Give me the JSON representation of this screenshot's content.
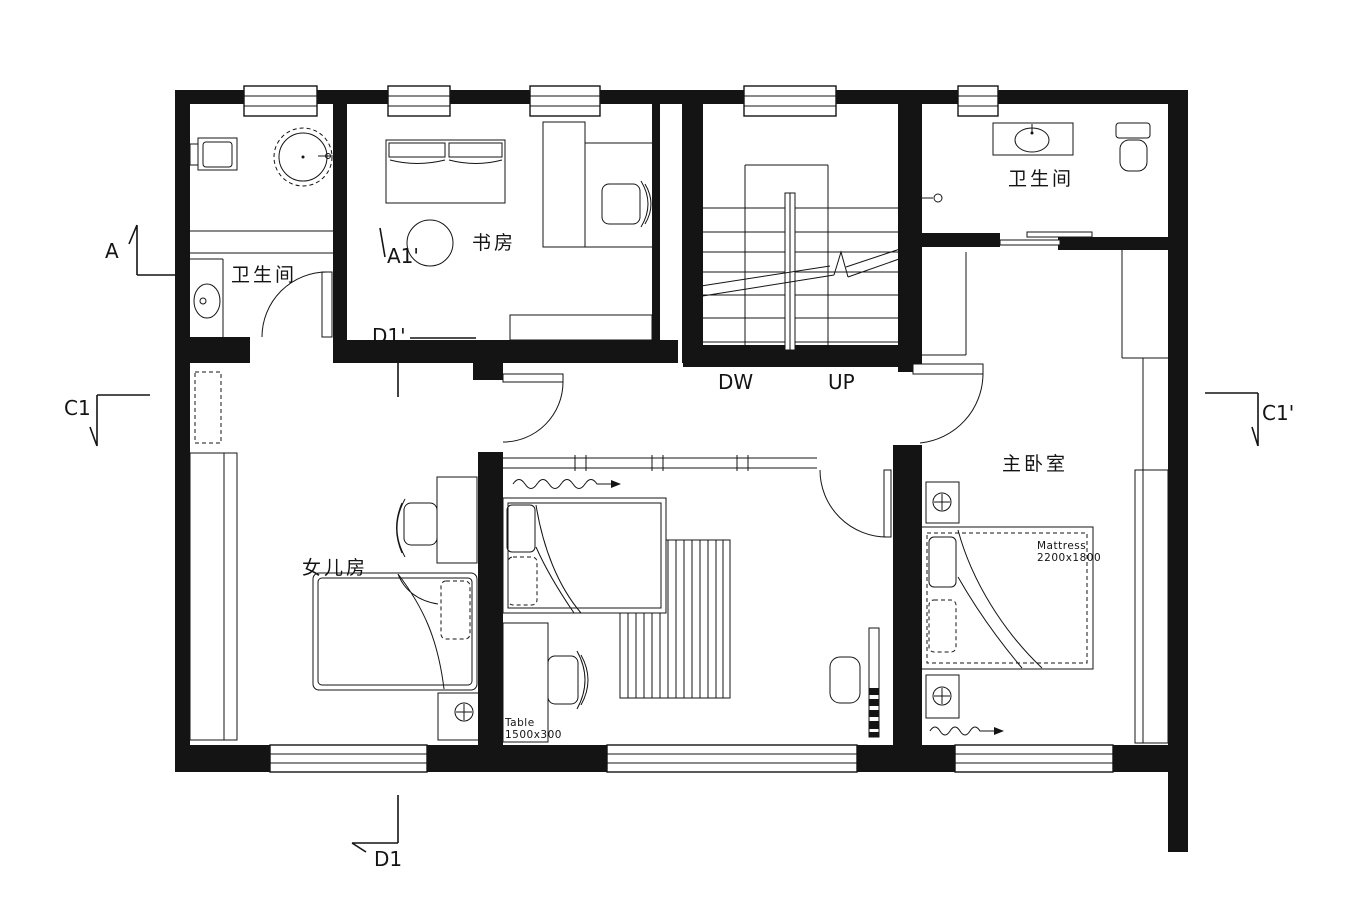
{
  "floorplan": {
    "background": "#ffffff",
    "line_color": "#141414",
    "rooms": {
      "bathroom_left": {
        "label": "卫生间"
      },
      "study": {
        "label": "书房"
      },
      "bathroom_upper_right": {
        "label": "卫生间"
      },
      "master_bedroom": {
        "label": "主卧室"
      },
      "daughter_room": {
        "label": "女儿房"
      }
    },
    "annotations": {
      "mattress": {
        "line1": "Mattress",
        "line2": "2200x1800"
      },
      "table": {
        "line1": "Table",
        "line2": "1500x300"
      }
    },
    "stairs": {
      "down": "DW",
      "up": "UP"
    },
    "section_markers": {
      "a": "A",
      "a1_prime": "A1'",
      "d1_prime": "D1'",
      "c1": "C1",
      "c1_prime": "C1'",
      "d1": "D1"
    }
  }
}
